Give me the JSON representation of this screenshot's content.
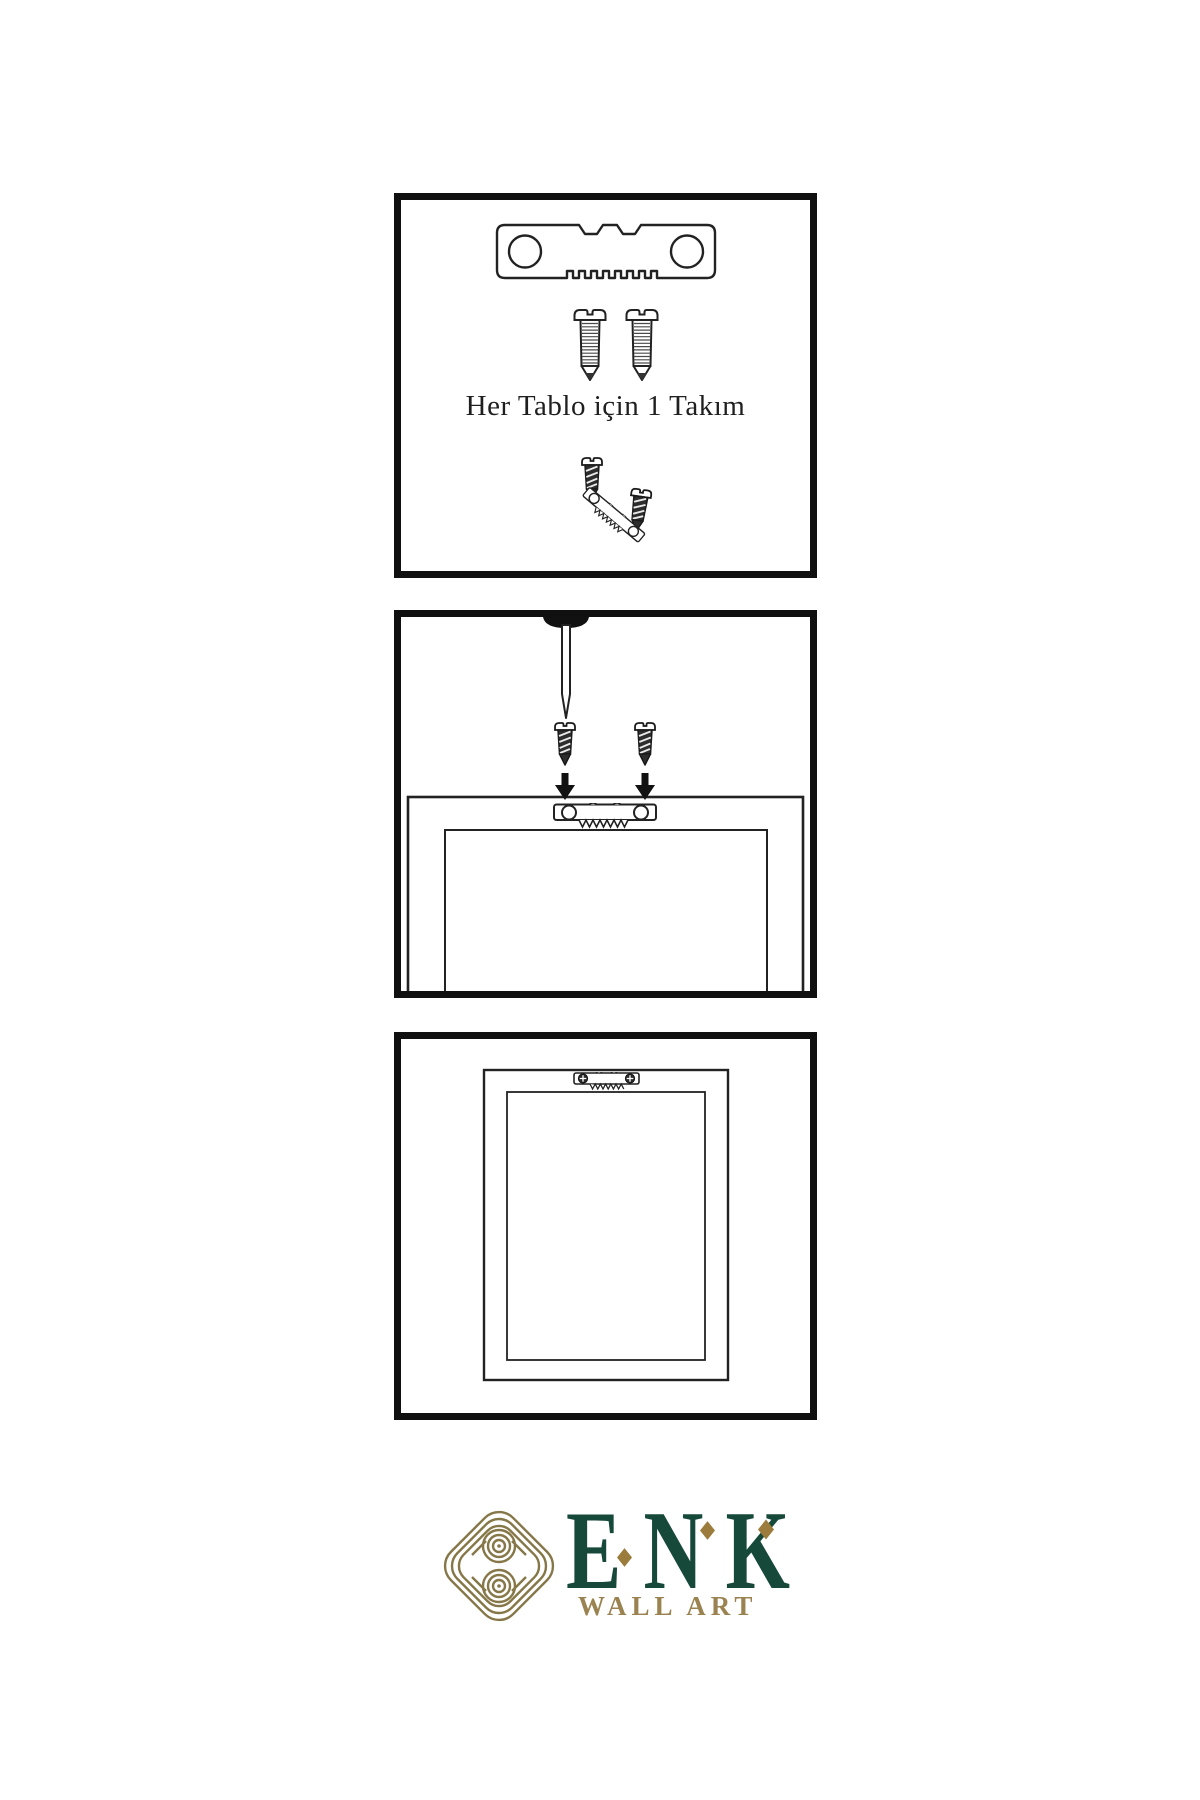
{
  "panel1": {
    "caption": "Her Tablo için 1 Takım"
  },
  "logo": {
    "brand": "ENK",
    "tagline": "WALL ART"
  },
  "colors": {
    "ink": "#101010",
    "brand_green": "#17493a",
    "brand_gold": "#9a8350",
    "knot_gold": "#867748",
    "diamond_gold": "#9b7c3c"
  },
  "icons": {
    "sawtooth-hanger-icon": "metal sawtooth picture hanger bar with two screw holes",
    "screw-icon": "threaded mounting screw with slotted head",
    "dark-screw-icon": "short dark screw with slotted head",
    "nail-icon": "wall nail driven through top edge",
    "arrow-down-icon": "solid black downward arrow",
    "frame-back-icon": "back of picture frame",
    "knot-logo-icon": "interlaced gold knot emblem",
    "diamond-icon": "gold diamond accent"
  }
}
